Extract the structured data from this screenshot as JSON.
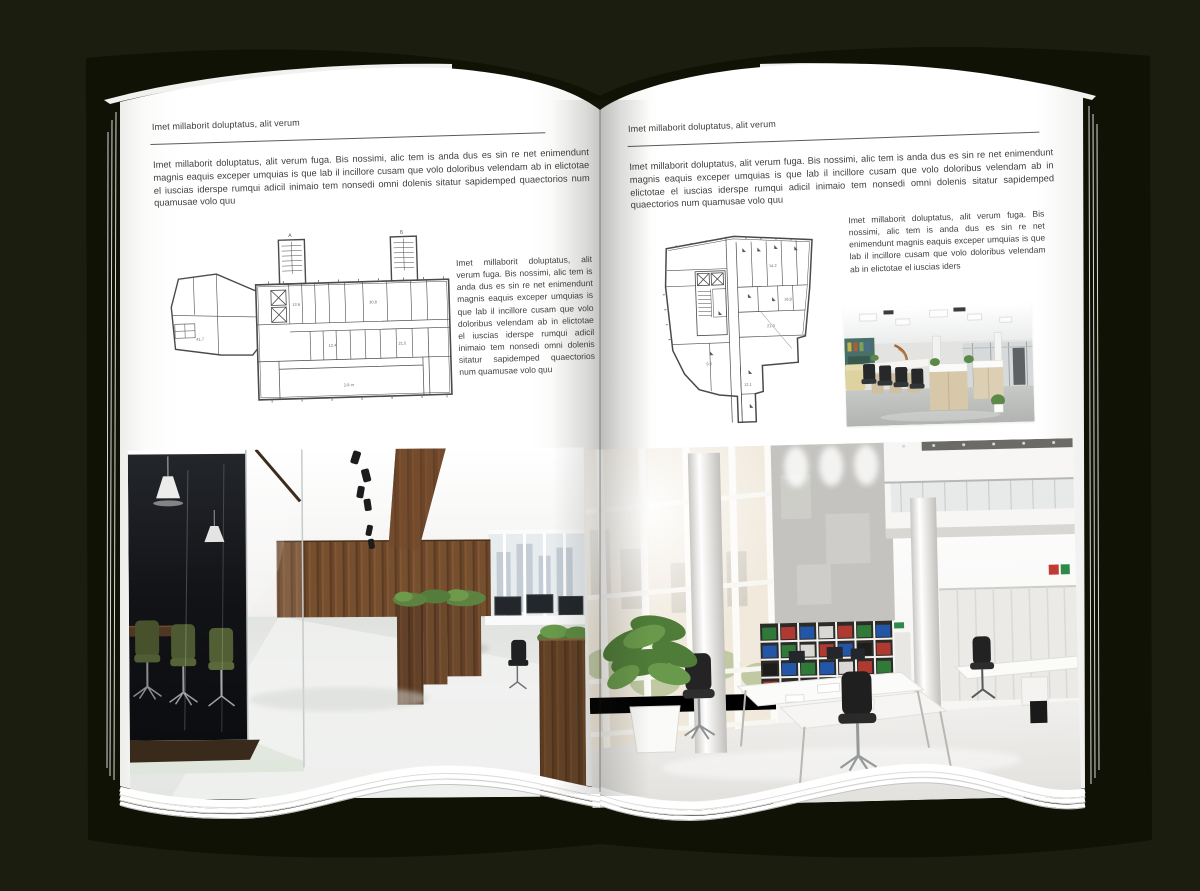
{
  "colors": {
    "background": "#1b1d0e",
    "cover": "#101205",
    "page": "#ffffff",
    "wood_wall": "#70492c",
    "conference_chair_green": "#4d5a31",
    "plant_green": "#4f7c38",
    "binder_red": "#b03a32",
    "binder_green": "#2f7a38",
    "binder_blue": "#2456a8"
  },
  "pages": {
    "left": {
      "header": "Imet millaborit doluptatus, alit verum",
      "intro": "Imet millaborit doluptatus, alit verum fuga. Bis nossimi, alic tem is anda dus es sin re net enimendunt magnis eaquis exceper umquias is que lab il incillore cusam que volo doloribus velendam ab in elictotae el iuscias iderspe rumqui adicil inimaio tem nonsedi omni dolenis sitatur sapidemped quaectorios num quamusae volo quu",
      "side_text": "Imet millaborit doluptatus, alit verum fuga. Bis nossimi, alic tem is anda dus es sin re net enimendunt magnis eaquis exceper umquias is que lab il incillore cusam que volo doloribus velendam ab in elictotae el iuscias iderspe rumqui adicil inimaio tem nonsedi omni dolenis sitatur sapidemped quaectorios num quamusae volo quu",
      "floorplan_labels": {
        "stair_a": "А",
        "stair_b": "Б",
        "room1": "30.8",
        "room2": "13.6",
        "room3": "12.4",
        "room4": "21.5",
        "room5": "41.7",
        "hall": "2-й эт"
      }
    },
    "right": {
      "header": "Imet millaborit doluptatus, alit verum",
      "intro": "Imet millaborit doluptatus, alit verum fuga. Bis nossimi, alic tem is anda dus es sin re net enimendunt magnis eaquis exceper umquias is que lab il incillore cusam que volo doloribus velendam ab in elictotae el iuscias iderspe rumqui adicil inimaio tem nonsedi omni dolenis sitatur sapidemped quaectorios num quamusae volo quu",
      "side_text": "Imet millaborit doluptatus, alit verum fuga. Bis nossimi, alic tem is anda dus es sin re net enimendunt magnis eaquis exceper umquias is que lab il incillore cusam que volo doloribus velendam ab in elictotae el iuscias iders",
      "floorplan_labels": {
        "room1": "14.2",
        "room2": "16.8",
        "room3": "21.3",
        "room4": "9.6",
        "room5": "12.1"
      }
    }
  }
}
